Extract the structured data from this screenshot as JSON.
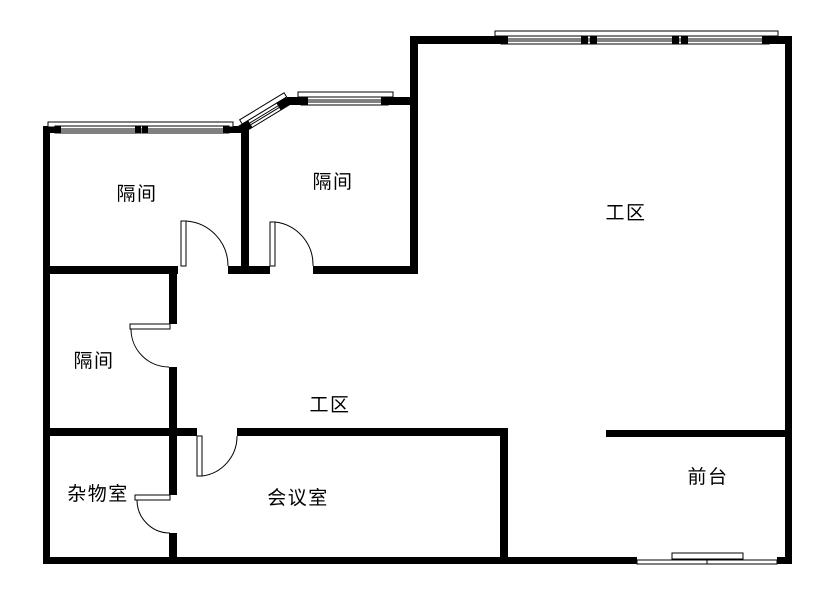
{
  "plan": {
    "type": "floor-plan",
    "background": "#ffffff",
    "wall_color": "#000000",
    "label_color": "#000000"
  },
  "rooms": [
    {
      "name": "cubicle-top-left",
      "label": "隔间"
    },
    {
      "name": "cubicle-top-middle",
      "label": "隔间"
    },
    {
      "name": "work-area-main",
      "label": "工区"
    },
    {
      "name": "cubicle-mid-left",
      "label": "隔间"
    },
    {
      "name": "work-area-center",
      "label": "工区"
    },
    {
      "name": "storage-room",
      "label": "杂物室"
    },
    {
      "name": "meeting-room",
      "label": "会议室"
    },
    {
      "name": "reception",
      "label": "前台"
    }
  ]
}
